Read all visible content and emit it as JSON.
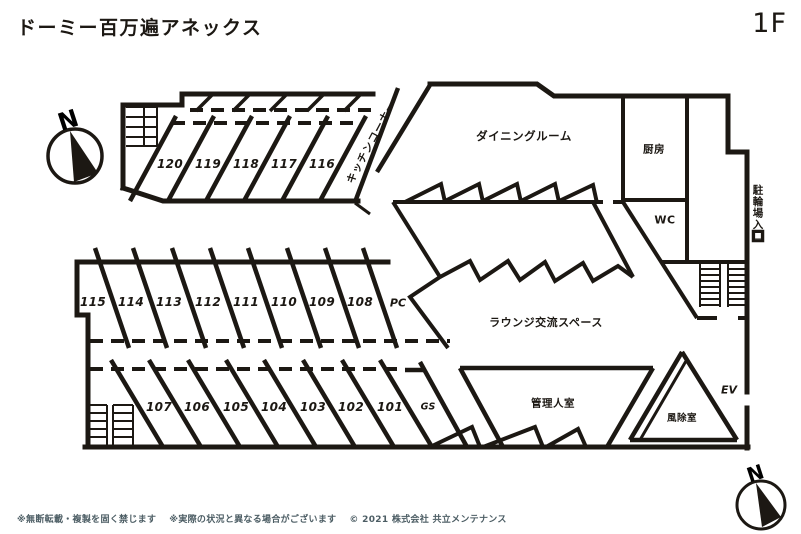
{
  "header": {
    "title": "ドーミー百万遍アネックス",
    "floor": "1F"
  },
  "compass": {
    "north": "N"
  },
  "rooms": {
    "upper": [
      "120",
      "119",
      "118",
      "117",
      "116"
    ],
    "middle": [
      "115",
      "114",
      "113",
      "112",
      "111",
      "110",
      "109",
      "108"
    ],
    "lower": [
      "107",
      "106",
      "105",
      "104",
      "103",
      "102",
      "101"
    ]
  },
  "areas": {
    "kitchen_corner": "キッチンコーナー",
    "dining_room": "ダイニングルーム",
    "kitchen": "厨房",
    "wc": "WC",
    "bicycle_entrance": "駐輪場入口",
    "lounge": "ラウンジ交流スペース",
    "pc": "PC",
    "gs": "GS",
    "manager_room": "管理人室",
    "windbreak_room": "風除室",
    "elevator": "EV"
  },
  "footer": {
    "notice1": "※無断転載・複製を固く禁じます",
    "notice2": "※実際の状況と異なる場合がございます",
    "copyright": "© 2021 株式会社 共立メンテナンス"
  },
  "colors": {
    "wall": "#1c1813",
    "footer_text": "#4c5d64",
    "background": "#ffffff"
  }
}
